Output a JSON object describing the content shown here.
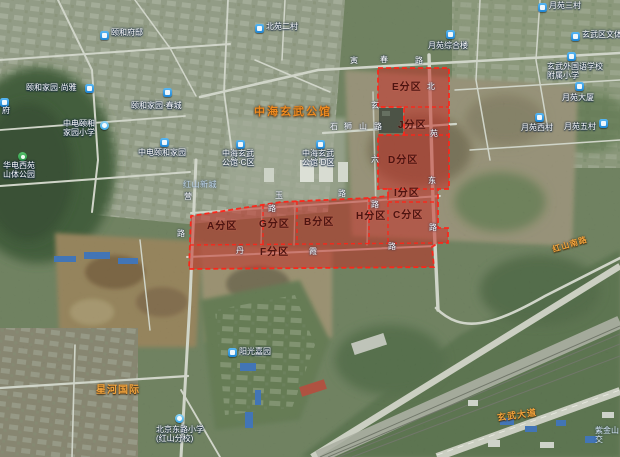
{
  "colors": {
    "zone_fill": "#c62a22",
    "zone_border": "#ff2418",
    "marker_blue": "#2e9fe6",
    "marker_green": "#3fae57",
    "marker_school": "#5ec0f2",
    "landmark_orange": "#ef8a1f",
    "road_orange": "#f2a33c"
  },
  "landmark": {
    "text": "中海玄武公馆"
  },
  "area_labels": {
    "hongshan": {
      "text": "红山新城"
    },
    "zijinshan": {
      "line1": "紫金山",
      "line2": "交"
    }
  },
  "zones": [
    {
      "id": "a",
      "label": "A分区",
      "x": 207,
      "y": 222
    },
    {
      "id": "g",
      "label": "G分区",
      "x": 259,
      "y": 220
    },
    {
      "id": "b",
      "label": "B分区",
      "x": 304,
      "y": 218
    },
    {
      "id": "h",
      "label": "H分区",
      "x": 356,
      "y": 212
    },
    {
      "id": "c",
      "label": "C分区",
      "x": 393,
      "y": 211
    },
    {
      "id": "i",
      "label": "I分区",
      "x": 394,
      "y": 189
    },
    {
      "id": "f",
      "label": "F分区",
      "x": 260,
      "y": 248
    },
    {
      "id": "e",
      "label": "E分区",
      "x": 392,
      "y": 83
    },
    {
      "id": "j",
      "label": "J分区",
      "x": 398,
      "y": 121
    },
    {
      "id": "d",
      "label": "D分区",
      "x": 388,
      "y": 156
    }
  ],
  "pois": [
    {
      "type": "blue",
      "mx": 100,
      "my": 31,
      "lx": 111,
      "ly": 28,
      "lines": [
        "颐和府邸"
      ]
    },
    {
      "type": "blue",
      "mx": 255,
      "my": 24,
      "lx": 266,
      "ly": 22,
      "lines": [
        "北苑二村"
      ]
    },
    {
      "type": "blue",
      "mx": 538,
      "my": 3,
      "lx": 549,
      "ly": 1,
      "lines": [
        "月苑三村"
      ]
    },
    {
      "type": "blue",
      "mx": 446,
      "my": 30,
      "lx": 428,
      "ly": 41,
      "lines": [
        "月苑综合楼"
      ]
    },
    {
      "type": "blue",
      "mx": 571,
      "my": 32,
      "lx": 582,
      "ly": 30,
      "lines": [
        "玄武区文体"
      ]
    },
    {
      "type": "blue",
      "mx": 567,
      "my": 52,
      "lx": 547,
      "ly": 62,
      "lines": [
        "玄武外国语学校",
        "附属小学"
      ]
    },
    {
      "type": "blue",
      "mx": 575,
      "my": 82,
      "lx": 562,
      "ly": 93,
      "lines": [
        "月苑大厦"
      ]
    },
    {
      "type": "blue",
      "mx": 535,
      "my": 113,
      "lx": 521,
      "ly": 123,
      "lines": [
        "月苑西村"
      ]
    },
    {
      "type": "blue",
      "mx": 599,
      "my": 119,
      "lx": 564,
      "ly": 122,
      "lines": [
        "月苑五村"
      ]
    },
    {
      "type": "blue",
      "mx": 85,
      "my": 84,
      "lx": 26,
      "ly": 83,
      "lines": [
        "颐和家园·尚雅"
      ]
    },
    {
      "type": "blue",
      "mx": 163,
      "my": 88,
      "lx": 131,
      "ly": 101,
      "lines": [
        "颐和家园·春城"
      ]
    },
    {
      "type": "school",
      "mx": 100,
      "my": 121,
      "lx": 63,
      "ly": 119,
      "lines": [
        "中电颐和",
        "家园小学"
      ]
    },
    {
      "type": "blue",
      "mx": 160,
      "my": 138,
      "lx": 138,
      "ly": 148,
      "lines": [
        "中电颐和家园"
      ]
    },
    {
      "type": "blue",
      "mx": 236,
      "my": 140,
      "lx": 222,
      "ly": 149,
      "lines": [
        "中海玄武",
        "公馆·C区"
      ]
    },
    {
      "type": "blue",
      "mx": 316,
      "my": 140,
      "lx": 302,
      "ly": 149,
      "lines": [
        "中海玄武",
        "公馆·D区"
      ]
    },
    {
      "type": "blue",
      "mx": 228,
      "my": 348,
      "lx": 239,
      "ly": 347,
      "lines": [
        "阳光嘉园"
      ]
    },
    {
      "type": "school",
      "mx": 175,
      "my": 414,
      "lx": 156,
      "ly": 425,
      "lines": [
        "北京东路小学",
        "(红山分校)"
      ]
    },
    {
      "type": "green",
      "mx": 18,
      "my": 152,
      "lx": 3,
      "ly": 161,
      "lines": [
        "华电西苑",
        "山体公园"
      ]
    },
    {
      "type": "blue",
      "mx": 0,
      "my": 98,
      "lx": 2,
      "ly": 106,
      "lines": [
        "府"
      ]
    }
  ],
  "road_chars": [
    {
      "ch": "寅",
      "x": 350,
      "y": 57
    },
    {
      "ch": "春",
      "x": 380,
      "y": 56
    },
    {
      "ch": "路",
      "x": 415,
      "y": 57
    },
    {
      "ch": "石",
      "x": 330,
      "y": 123
    },
    {
      "ch": "狮",
      "x": 344,
      "y": 123
    },
    {
      "ch": "山",
      "x": 359,
      "y": 123
    },
    {
      "ch": "路",
      "x": 374,
      "y": 123
    },
    {
      "ch": "北",
      "x": 427,
      "y": 83
    },
    {
      "ch": "苑",
      "x": 430,
      "y": 130
    },
    {
      "ch": "东",
      "x": 428,
      "y": 177
    },
    {
      "ch": "路",
      "x": 429,
      "y": 224
    },
    {
      "ch": "玄",
      "x": 371,
      "y": 102
    },
    {
      "ch": "六",
      "x": 371,
      "y": 156
    },
    {
      "ch": "路",
      "x": 371,
      "y": 201
    },
    {
      "ch": "营",
      "x": 184,
      "y": 193
    },
    {
      "ch": "路",
      "x": 177,
      "y": 230
    },
    {
      "ch": "玉",
      "x": 275,
      "y": 192
    },
    {
      "ch": "路",
      "x": 338,
      "y": 190
    },
    {
      "ch": "路",
      "x": 268,
      "y": 205
    },
    {
      "ch": "丹",
      "x": 236,
      "y": 247
    },
    {
      "ch": "霞",
      "x": 309,
      "y": 248
    },
    {
      "ch": "路",
      "x": 388,
      "y": 243
    }
  ],
  "orange_roads": [
    {
      "text": "红山南路",
      "x": 552,
      "y": 239,
      "rot": -17,
      "size": 8
    },
    {
      "text": "玄武大道",
      "x": 497,
      "y": 408,
      "rot": -8,
      "size": 9
    },
    {
      "text": "星河国际",
      "x": 96,
      "y": 381,
      "rot": 0,
      "size": 10
    }
  ]
}
